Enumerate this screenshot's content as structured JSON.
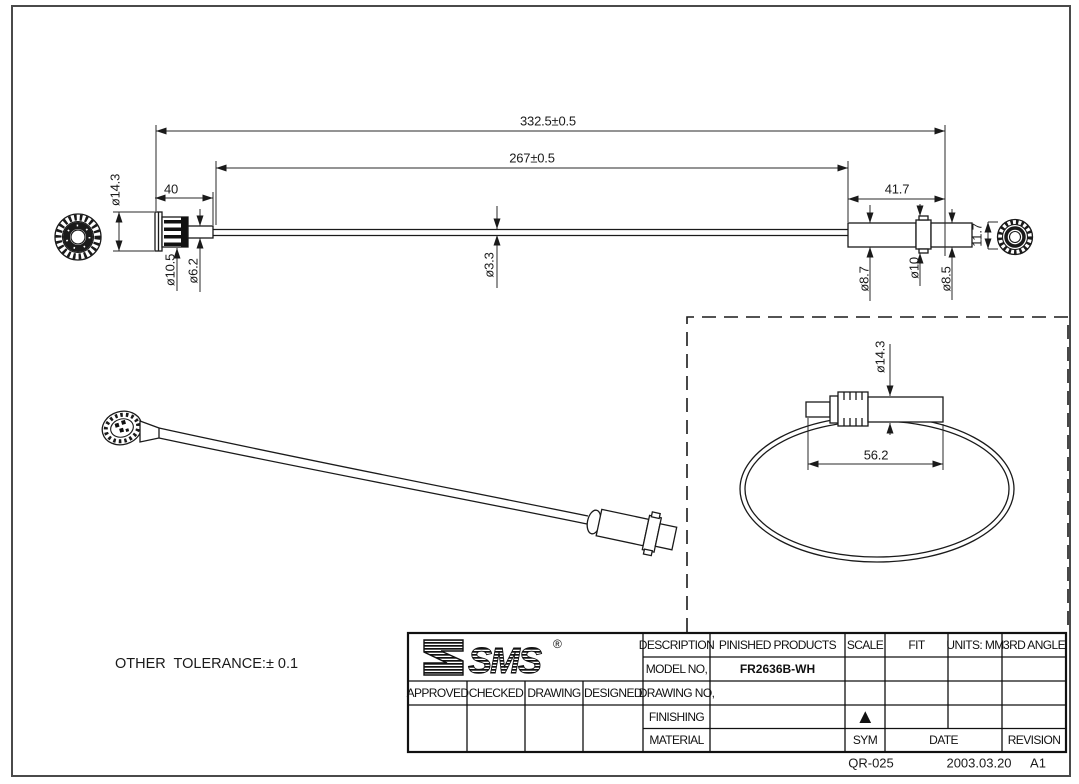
{
  "page": {
    "tolerance_note": "OTHER  TOLERANCE:± 0.1",
    "footer": {
      "doc_no": "QR-025",
      "date": "2003.03.20",
      "revision": "A1"
    }
  },
  "dimensions": {
    "top_view": {
      "overall_length": "332.5±0.5",
      "cable_length": "267±0.5",
      "left_connector_length": "40",
      "right_connector_length": "41.7",
      "left_flange_dia": "ø14.3",
      "left_knurl_dia": "ø10.5",
      "left_barrel_dia": "ø6.2",
      "cable_dia": "ø3.3",
      "right_barrel_dia": "ø8.7",
      "right_collar_dia": "ø10",
      "right_tip_dia": "ø8.5",
      "right_end_height": "11.7"
    },
    "detail_view": {
      "flange_dia": "ø14.3",
      "connector_length": "56.2"
    }
  },
  "title_block": {
    "logo": {
      "text": "SMS",
      "registered": "®"
    },
    "approval_columns": [
      "APPROVED",
      "CHECKED",
      "DRAWING",
      "DESIGNED"
    ],
    "labels": {
      "description": "DESCRIPTION",
      "model_no": "MODEL NO,",
      "drawing_no": "DRAWING NO,",
      "finishing": "FINISHING",
      "material": "MATERIAL",
      "scale": "SCALE",
      "fit": "FIT",
      "units": "UNITS: MM",
      "angle": "3RD ANGLE",
      "sym": "SYM",
      "date": "DATE",
      "revision": "REVISION"
    },
    "values": {
      "description": "PINISHED PRODUCTS",
      "model_no": "FR2636B-WH",
      "sym_mark": "▲"
    }
  }
}
